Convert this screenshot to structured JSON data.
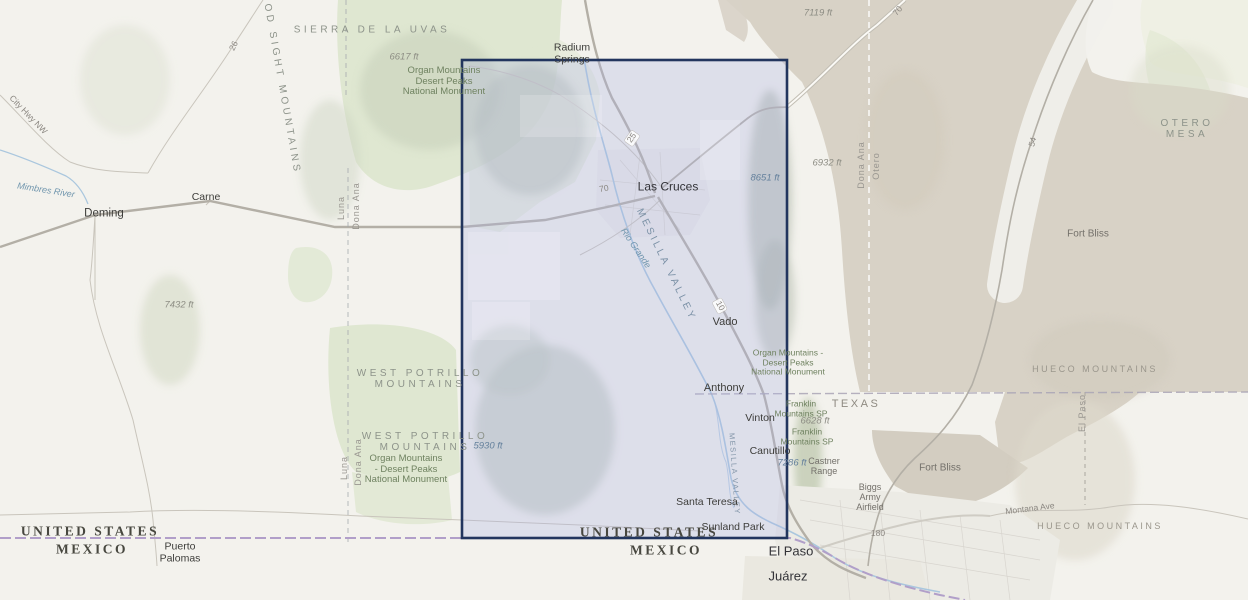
{
  "map": {
    "type": "topographic-basemap",
    "region": "Southern New Mexico / West Texas (Las Cruces – El Paso)",
    "selection_overlay": {
      "description": "rectangular extent selection over the Mesilla Valley",
      "border_color": "#22355e",
      "fill_color": "rgba(173,178,228,0.30)"
    },
    "colors": {
      "land": "#f3f2ed",
      "protected_green": "#dfe7d1",
      "military_tan": "#d8d2c6",
      "water_blue": "#aac7de",
      "intl_border_purple": "#b19fc9",
      "road_gray": "#b3afa6"
    }
  },
  "labels": {
    "sierra_de_la_uvas": "SIERRA DE LA UVAS",
    "elev_6617": "6617 ft",
    "monument_nw": "Organ Mountains\nDesert Peaks\nNational Monument",
    "radium_springs": "Radium\nSprings",
    "good_sight_mountains": "GOOD SIGHT MOUNTAINS",
    "city_hwy_nw": "City Hwy NW",
    "route_26": "26",
    "mimbres_river": "Mimbres River",
    "deming": "Deming",
    "carne": "Carne",
    "county_luna_n": "Luna",
    "county_dona_ana_n": "Dona Ana",
    "elev_7432": "7432 ft",
    "west_potrillo_1": "WEST POTRILLO\nMOUNTAINS",
    "west_potrillo_2": "WEST POTRILLO\nMOUNTAINS",
    "monument_sw": "Organ Mountains\n- Desert Peaks\nNational Monument",
    "county_luna_s": "Luna",
    "county_dona_ana_s": "Dona Ana",
    "elev_5930": "5930 ft",
    "las_cruces": "Las Cruces",
    "route_70_w": "70",
    "route_25": "25",
    "mesilla_valley": "MESILLA VALLEY",
    "rio_grande": "Rio Grande",
    "route_10": "10",
    "vado": "Vado",
    "monument_e": "Organ Mountains -\nDesert Peaks\nNational Monument",
    "elev_6932": "6932 ft",
    "elev_8651": "8651 ft",
    "county_dona_ana_e": "Dona Ana",
    "county_otero": "Otero",
    "elev_7119": "7119 ft",
    "route_70_ne": "70",
    "otero_mesa": "OTERO MESA",
    "fort_bliss_n": "Fort Bliss",
    "route_54": "54",
    "anthony": "Anthony",
    "vinton": "Vinton",
    "canutillo": "Canutillo",
    "mesilla_valley_s": "MESILLA VALLEY",
    "texas": "TEXAS",
    "franklin_sp_1": "Franklin\nMountains SP",
    "elev_6628": "6628 ft",
    "franklin_sp_2": "Franklin\nMountains SP",
    "elev_7286": "7286 ft",
    "castner_range": "Castner\nRange",
    "fort_bliss_s": "Fort Bliss",
    "biggs_army_airfield": "Biggs\nArmy\nAirfield",
    "route_180": "180",
    "montana_ave": "Montana Ave",
    "hueco_mountains_n": "HUECO MOUNTAINS",
    "hueco_mountains_s": "HUECO MOUNTAINS",
    "county_el_paso": "El Paso",
    "santa_teresa": "Santa Teresa",
    "sunland_park": "Sunland Park",
    "united_states_w": "UNITED STATES",
    "mexico_w": "MEXICO",
    "puerto_palomas": "Puerto\nPalomas",
    "united_states_c": "UNITED STATES",
    "mexico_c": "MEXICO",
    "el_paso_city": "El Paso",
    "juarez_city": "Juárez"
  }
}
